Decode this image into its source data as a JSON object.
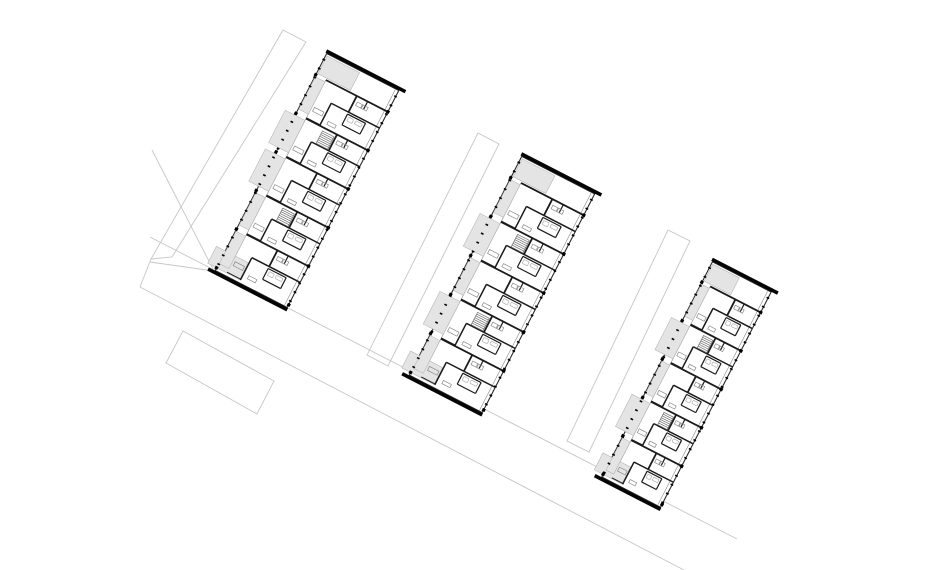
{
  "canvas": {
    "width": 940,
    "height": 570
  },
  "colors": {
    "background": "#ffffff",
    "outline": "#2a2a2a",
    "interior_wall": "#1b1b1b",
    "thin_line": "#8a8a8a",
    "fixture_line": "#b0b0b0",
    "gray_fill": "#e4e4e4",
    "gray_fill_border": "#adadad",
    "end_bar": "#050505",
    "tick": "#000000",
    "site_line": "#c6c6c6",
    "stair_line": "#6f6f6f"
  },
  "site": {
    "parcels": [
      {
        "name": "site-strip-a",
        "points": [
          [
            283,
            30
          ],
          [
            306,
            42
          ],
          [
            172,
            257
          ],
          [
            151,
            259
          ]
        ]
      },
      {
        "name": "site-strip-b",
        "points": [
          [
            478,
            133
          ],
          [
            499,
            144
          ],
          [
            388,
            366
          ],
          [
            367,
            355
          ]
        ]
      },
      {
        "name": "site-strip-c",
        "points": [
          [
            668,
            230
          ],
          [
            690,
            241
          ],
          [
            589,
            452
          ],
          [
            567,
            441
          ]
        ]
      },
      {
        "name": "site-parcel-rect",
        "points": [
          [
            183,
            331
          ],
          [
            274,
            381
          ],
          [
            257,
            414
          ],
          [
            166,
            363
          ]
        ]
      }
    ],
    "segments": [
      {
        "name": "site-boundary-u1",
        "x1": 150,
        "y1": 237,
        "x2": 737,
        "y2": 539
      },
      {
        "name": "site-boundary-u2",
        "x1": 140,
        "y1": 287,
        "x2": 684,
        "y2": 570
      },
      {
        "name": "site-boundary-b1",
        "x1": 152,
        "y1": 150,
        "x2": 214,
        "y2": 271
      },
      {
        "name": "site-boundary-cross",
        "x1": 150,
        "y1": 262,
        "x2": 214,
        "y2": 271
      },
      {
        "name": "site-boundary-a-ext",
        "x1": 151,
        "y1": 259,
        "x2": 140,
        "y2": 287
      }
    ]
  },
  "buildings": [
    {
      "name": "building-1",
      "cx": 307,
      "cy": 180.5,
      "w": 81,
      "l": 244,
      "angle": 27.2,
      "top_zone": 24,
      "modules": 5,
      "bump_modules": [
        1,
        2
      ],
      "stair_modules": [
        1,
        3
      ]
    },
    {
      "name": "building-2",
      "cx": 502,
      "cy": 284.5,
      "w": 82,
      "l": 246,
      "angle": 27.2,
      "top_zone": 24,
      "modules": 5,
      "bump_modules": [
        1,
        3
      ],
      "stair_modules": [
        1,
        3
      ]
    },
    {
      "name": "building-3",
      "cx": 686.5,
      "cy": 384.5,
      "w": 66,
      "l": 242,
      "angle": 27.2,
      "top_zone": 23,
      "modules": 5,
      "bump_modules": [
        1,
        3
      ],
      "stair_modules": [
        1,
        3
      ]
    }
  ],
  "module_template": {
    "balcony_frac": 0.14,
    "bump_extend": 11,
    "walls": [
      {
        "x1": 0.14,
        "y1": 0,
        "x2": 1,
        "y2": 0,
        "t": 1.8
      },
      {
        "x1": 0.57,
        "y1": 0,
        "x2": 0.57,
        "y2": 0.42,
        "t": 1.8
      },
      {
        "x1": 0.33,
        "y1": 0.42,
        "x2": 1,
        "y2": 0.42,
        "t": 1.5
      },
      {
        "x1": 0.33,
        "y1": 0.42,
        "x2": 0.33,
        "y2": 1,
        "t": 1.5
      },
      {
        "x1": 0.57,
        "y1": 0.47,
        "x2": 0.82,
        "y2": 0.47,
        "t": 1.2
      },
      {
        "x1": 0.82,
        "y1": 0.47,
        "x2": 0.82,
        "y2": 0.75,
        "t": 1.2
      },
      {
        "x1": 0.57,
        "y1": 0.75,
        "x2": 0.82,
        "y2": 0.75,
        "t": 1.2
      },
      {
        "x1": 0.57,
        "y1": 0.47,
        "x2": 0.57,
        "y2": 0.75,
        "t": 1.2
      },
      {
        "x1": 0.72,
        "y1": 0,
        "x2": 0.72,
        "y2": 0.2,
        "t": 1.2
      },
      {
        "x1": 0.14,
        "y1": 0.98,
        "x2": 0.33,
        "y2": 0.98,
        "t": 1.0
      }
    ],
    "furniture": [
      {
        "x": 0.17,
        "y": 0.68,
        "w": 0.13,
        "h": 0.1
      },
      {
        "x": 0.61,
        "y": 0.12,
        "w": 0.07,
        "h": 0.09
      },
      {
        "x": 0.69,
        "y": 0.12,
        "w": 0.07,
        "h": 0.09
      },
      {
        "x": 0.4,
        "y": 0.82,
        "w": 0.11,
        "h": 0.08
      }
    ],
    "bath_fixtures": [
      {
        "x": 0.6,
        "y": 0.52,
        "w": 0.07,
        "h": 0.1
      },
      {
        "x": 0.7,
        "y": 0.52,
        "w": 0.09,
        "h": 0.08
      }
    ],
    "stairs": {
      "x": 0.39,
      "y": 0.08,
      "w": 0.16,
      "h": 0.32,
      "rungs": 7
    }
  },
  "ticks": {
    "step": 10,
    "len": 2.8,
    "th": 1.6
  },
  "end_bar": {
    "thickness": 3.6,
    "overhang": 8
  }
}
